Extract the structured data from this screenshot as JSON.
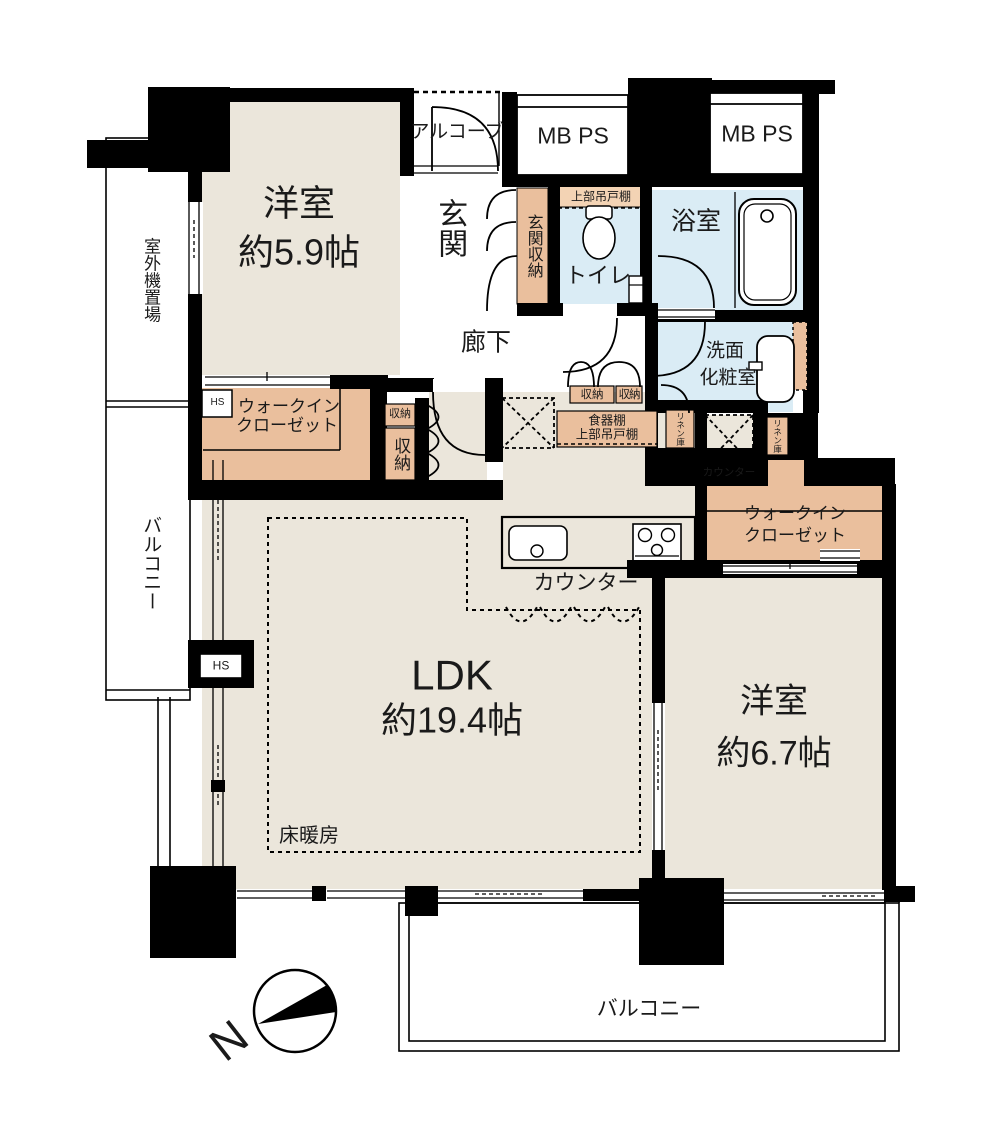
{
  "title": "マンション間取り図 2LDK",
  "colors": {
    "bg": "#ffffff",
    "wall": "#000000",
    "room": "#ebe6db",
    "wet": "#daecf5",
    "closet": "#eabf9d",
    "cabinet": "#f3d3b4"
  },
  "labels": {
    "room_west1_name": "洋室",
    "room_west1_size": "約5.9帖",
    "alcove": "アルコーブ",
    "mb_ps_1": "MB PS",
    "mb_ps_2": "MB PS",
    "entrance": "玄関",
    "entrance_storage": "玄関収納",
    "upper_cabinet": "上部吊戸棚",
    "toilet": "トイレ",
    "bathroom": "浴室",
    "hallway": "廊下",
    "washroom_line1": "洗面",
    "washroom_line2": "化粧室",
    "outdoor_unit": "室外機置場",
    "balcony_left": "バルコニー",
    "wic_left_line1": "ウォークイン",
    "wic_left_line2": "クローゼット",
    "hs_wic": "HS",
    "storage_small": "収納",
    "storage_tall": "収納",
    "storage_pair_1": "収納",
    "storage_pair_2": "収納",
    "cupboard_line1": "食器棚",
    "cupboard_line2": "上部吊戸棚",
    "linen_left": "リネン庫",
    "linen_right": "リネン庫",
    "counter_small": "カウンター",
    "counter_kitchen": "カウンター",
    "wic_right_line1": "ウォークイン",
    "wic_right_line2": "クローゼット",
    "ldk_name": "LDK",
    "ldk_size": "約19.4帖",
    "floor_heating": "床暖房",
    "hs_ldk": "HS",
    "room_west2_name": "洋室",
    "room_west2_size": "約6.7帖",
    "balcony_bottom": "バルコニー",
    "north": "N"
  }
}
